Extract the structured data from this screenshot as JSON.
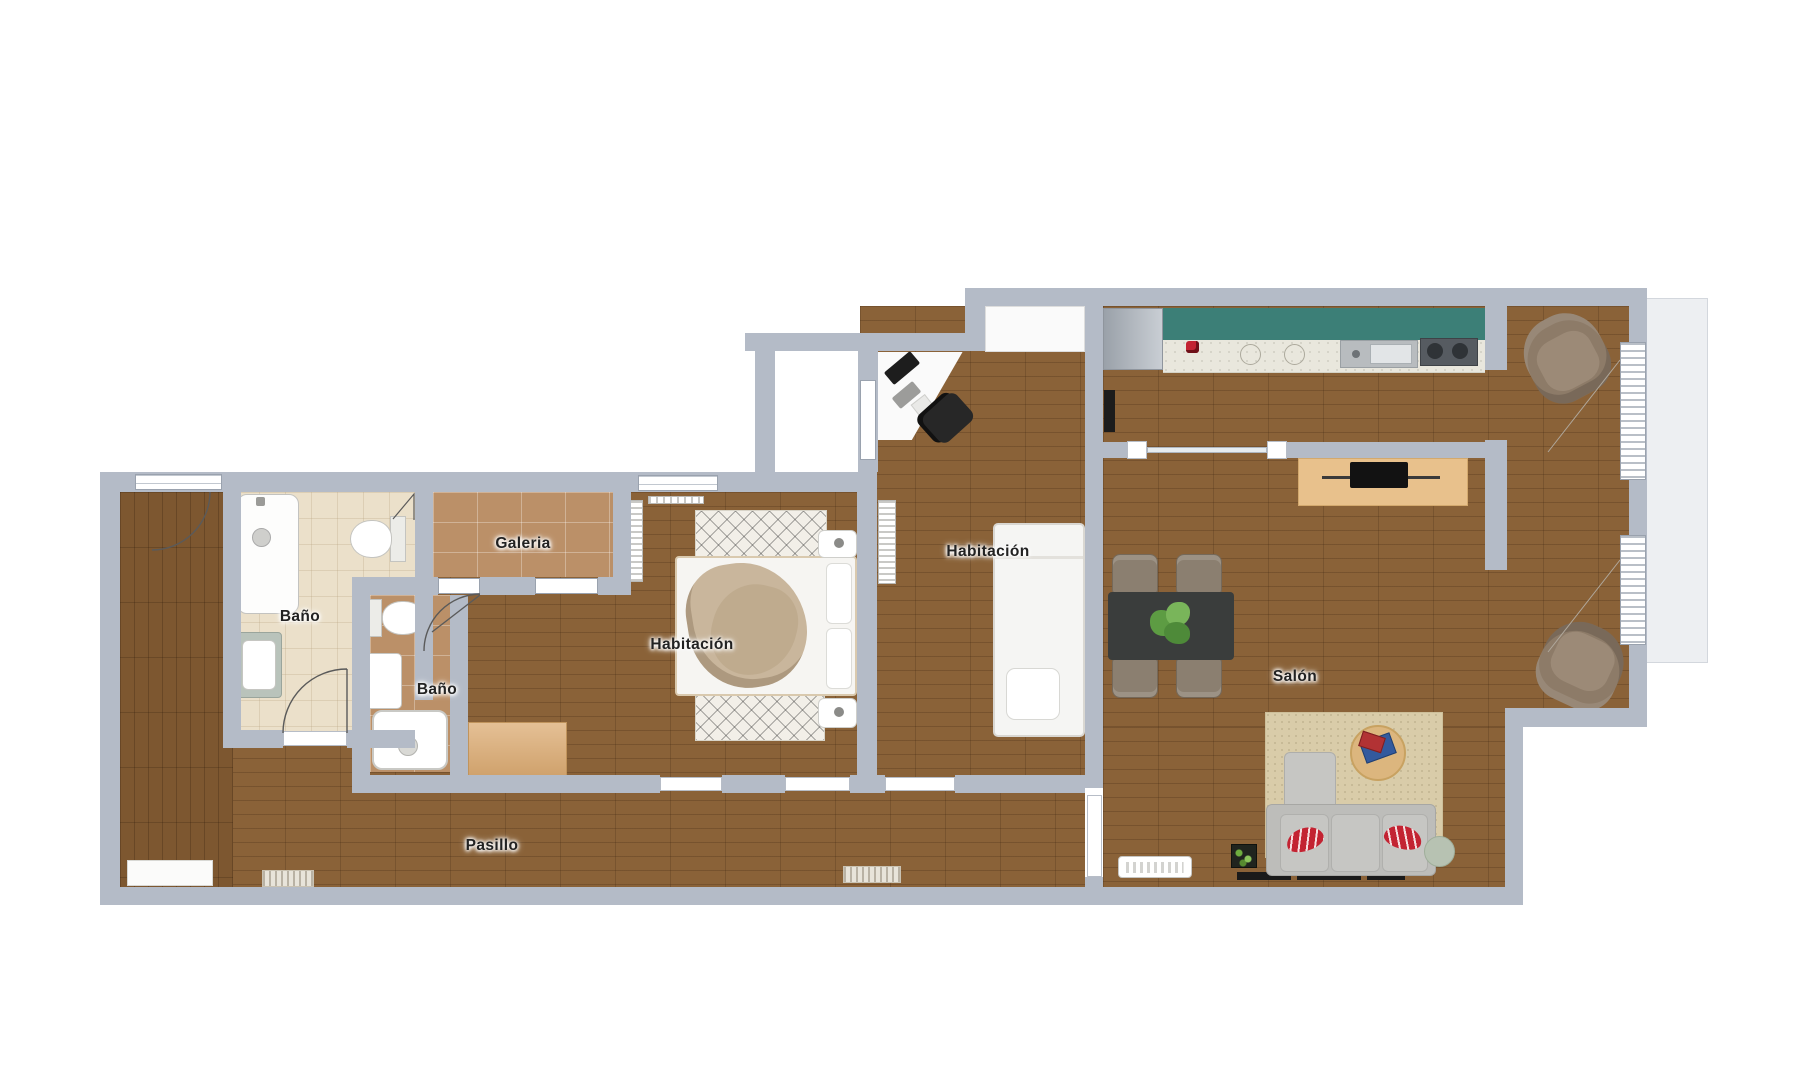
{
  "title": "Plano de vivienda",
  "rooms": [
    {
      "name": "bano-principal",
      "label": "Baño"
    },
    {
      "name": "galeria",
      "label": "Galeria"
    },
    {
      "name": "bano-pequeno",
      "label": "Baño"
    },
    {
      "name": "habitacion-principal",
      "label": "Habitación"
    },
    {
      "name": "habitacion-secundaria",
      "label": "Habitación"
    },
    {
      "name": "salon",
      "label": "Salón"
    },
    {
      "name": "pasillo",
      "label": "Pasillo"
    }
  ],
  "palette": {
    "wall": "#b4bbc7",
    "wood": "#8a6238",
    "wood-dark": "#7d5730",
    "tile": "#bb9068",
    "bath": "#ebe0ca",
    "teal": "#3c7f77",
    "counter": "#e9e7dd",
    "rug": "#d9cca9",
    "bedrug": "#f2efe8",
    "sofa": "#c6c6c3",
    "red": "#c32332",
    "armchair": "#8d7b68",
    "tabledark": "#3a3d3c",
    "woodlight": "#e8c18c",
    "wardrobe": "#dcab72",
    "plant": "#6aa348",
    "balcony": "#edeff2",
    "sidetable": "#b7c2b2"
  }
}
